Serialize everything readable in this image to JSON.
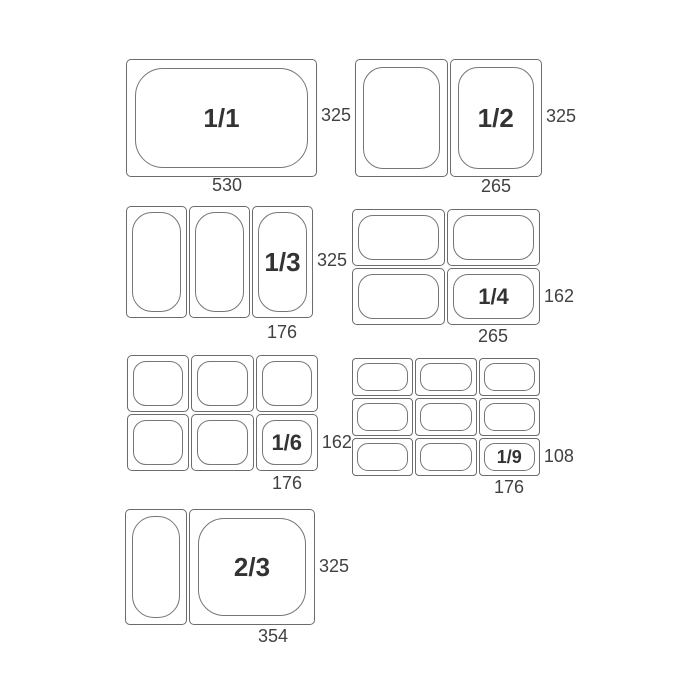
{
  "diagram": {
    "background": "#ffffff",
    "line_color": "#6b6b6b",
    "fraction_color": "#333333",
    "dimension_color": "#414141",
    "groups": {
      "g11": {
        "fraction": "1/1",
        "cols": 1,
        "rows": 1,
        "bottom_mm": "530",
        "side_mm": "325"
      },
      "g12": {
        "fraction": "1/2",
        "cols": 2,
        "rows": 1,
        "bottom_mm": "265",
        "side_mm": "325"
      },
      "g13": {
        "fraction": "1/3",
        "cols": 3,
        "rows": 1,
        "bottom_mm": "176",
        "side_mm": "325"
      },
      "g14": {
        "fraction": "1/4",
        "cols": 2,
        "rows": 2,
        "bottom_mm": "265",
        "side_mm": "162"
      },
      "g16": {
        "fraction": "1/6",
        "cols": 3,
        "rows": 2,
        "bottom_mm": "176",
        "side_mm": "162"
      },
      "g19": {
        "fraction": "1/9",
        "cols": 3,
        "rows": 3,
        "bottom_mm": "176",
        "side_mm": "108"
      },
      "g23": {
        "fraction": "2/3",
        "cols": 2,
        "rows": 1,
        "bottom_mm": "354",
        "side_mm": "325"
      }
    }
  }
}
